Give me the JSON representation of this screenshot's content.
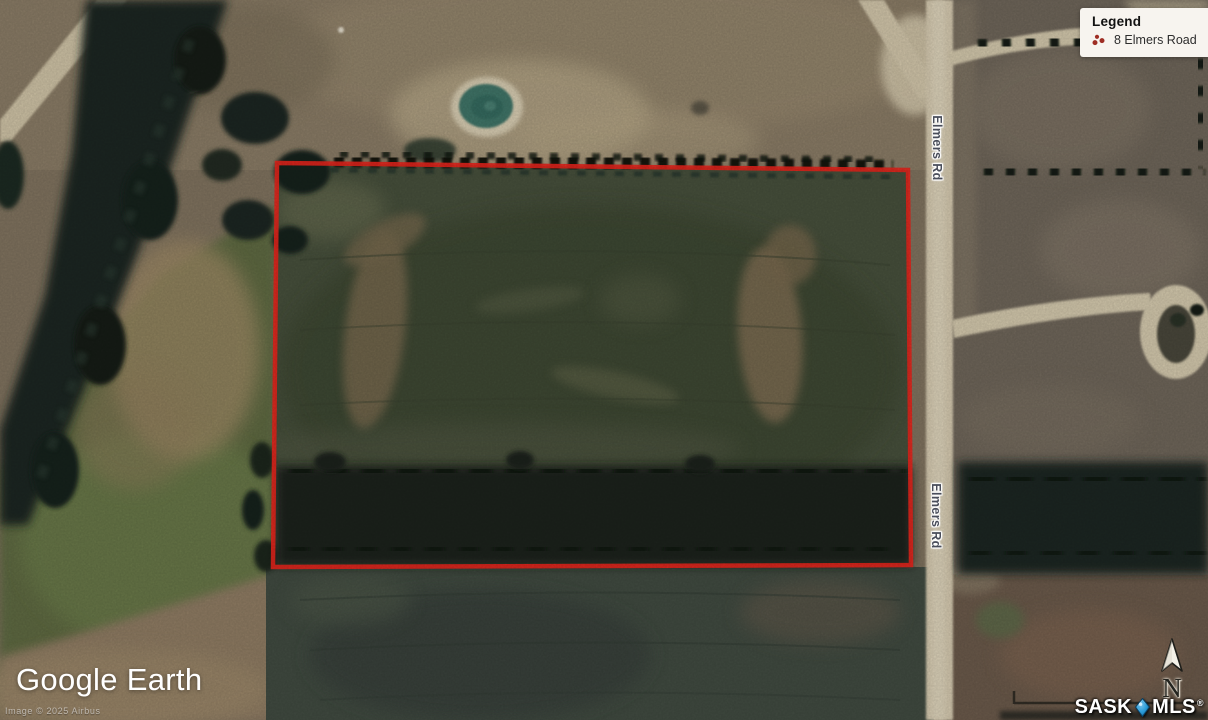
{
  "map": {
    "road_labels": [
      "Elmers Rd",
      "Elmers Rd"
    ],
    "boundary_color": "#e8251c"
  },
  "legend": {
    "title": "Legend",
    "items": [
      {
        "label": "8 Elmers Road",
        "marker_color": "#9e2d23"
      }
    ]
  },
  "watermark": {
    "brand_primary": "Google",
    "brand_secondary": "Earth",
    "attribution": "Image © 2025 Airbus"
  },
  "compass": {
    "north_label": "N"
  },
  "footer_logo": {
    "prefix": "SASK",
    "suffix": "MLS",
    "registered": "®",
    "pin_color": "#2b9cd8"
  }
}
